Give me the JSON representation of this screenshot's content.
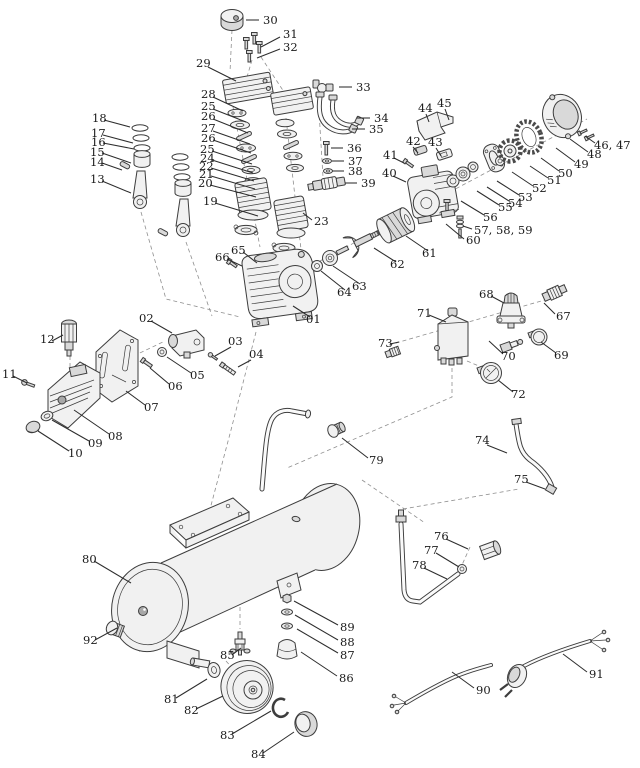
{
  "figure": {
    "background_color": "#ffffff",
    "line_color": "#3d3d3d",
    "label_color": "#1b1b1b",
    "leader_color": "#2d2d2d",
    "dashed_guide_color": "#8f8f8f"
  },
  "labels": [
    {
      "t": "30",
      "x": 263,
      "y": 24,
      "x1": 259,
      "y1": 20,
      "x2": 246,
      "y2": 20
    },
    {
      "t": "31",
      "x": 283,
      "y": 38,
      "x1": 280,
      "y1": 37,
      "x2": 261,
      "y2": 47
    },
    {
      "t": "32",
      "x": 283,
      "y": 51,
      "x1": 280,
      "y1": 49,
      "x2": 257,
      "y2": 58
    },
    {
      "t": "29",
      "x": 196,
      "y": 67,
      "x1": 208,
      "y1": 67,
      "x2": 236,
      "y2": 81
    },
    {
      "t": "28",
      "x": 201,
      "y": 98,
      "x1": 213,
      "y1": 97,
      "x2": 243,
      "y2": 111
    },
    {
      "t": "25",
      "x": 201,
      "y": 110,
      "x1": 213,
      "y1": 109,
      "x2": 246,
      "y2": 122
    },
    {
      "t": "26",
      "x": 201,
      "y": 120,
      "x1": 213,
      "y1": 119,
      "x2": 248,
      "y2": 133
    },
    {
      "t": "27",
      "x": 201,
      "y": 132,
      "x1": 213,
      "y1": 131,
      "x2": 250,
      "y2": 144
    },
    {
      "t": "26",
      "x": 201,
      "y": 142,
      "x1": 213,
      "y1": 140,
      "x2": 251,
      "y2": 153
    },
    {
      "t": "25",
      "x": 200,
      "y": 153,
      "x1": 212,
      "y1": 151,
      "x2": 252,
      "y2": 164
    },
    {
      "t": "24",
      "x": 200,
      "y": 162,
      "x1": 212,
      "y1": 160,
      "x2": 253,
      "y2": 173
    },
    {
      "t": "22",
      "x": 199,
      "y": 170,
      "x1": 211,
      "y1": 168,
      "x2": 254,
      "y2": 181
    },
    {
      "t": "21",
      "x": 199,
      "y": 178,
      "x1": 211,
      "y1": 176,
      "x2": 255,
      "y2": 189
    },
    {
      "t": "20",
      "x": 198,
      "y": 187,
      "x1": 210,
      "y1": 185,
      "x2": 256,
      "y2": 197
    },
    {
      "t": "19",
      "x": 203,
      "y": 205,
      "x1": 215,
      "y1": 203,
      "x2": 258,
      "y2": 216
    },
    {
      "t": "18",
      "x": 92,
      "y": 122,
      "x1": 104,
      "y1": 120,
      "x2": 130,
      "y2": 127
    },
    {
      "t": "17",
      "x": 91,
      "y": 137,
      "x1": 103,
      "y1": 135,
      "x2": 133,
      "y2": 143
    },
    {
      "t": "16",
      "x": 91,
      "y": 146,
      "x1": 103,
      "y1": 143,
      "x2": 134,
      "y2": 149
    },
    {
      "t": "15",
      "x": 90,
      "y": 156,
      "x1": 102,
      "y1": 153,
      "x2": 131,
      "y2": 163
    },
    {
      "t": "14",
      "x": 90,
      "y": 166,
      "x1": 102,
      "y1": 163,
      "x2": 122,
      "y2": 170
    },
    {
      "t": "13",
      "x": 90,
      "y": 183,
      "x1": 102,
      "y1": 181,
      "x2": 131,
      "y2": 193
    },
    {
      "t": "33",
      "x": 356,
      "y": 91,
      "x1": 352,
      "y1": 87,
      "x2": 339,
      "y2": 87
    },
    {
      "t": "34",
      "x": 374,
      "y": 122,
      "x1": 370,
      "y1": 118,
      "x2": 357,
      "y2": 118
    },
    {
      "t": "35",
      "x": 369,
      "y": 133,
      "x1": 365,
      "y1": 129,
      "x2": 352,
      "y2": 129
    },
    {
      "t": "36",
      "x": 347,
      "y": 152,
      "x1": 343,
      "y1": 148,
      "x2": 331,
      "y2": 148
    },
    {
      "t": "37",
      "x": 348,
      "y": 165,
      "x1": 344,
      "y1": 161,
      "x2": 332,
      "y2": 161
    },
    {
      "t": "38",
      "x": 348,
      "y": 175,
      "x1": 344,
      "y1": 171,
      "x2": 332,
      "y2": 171
    },
    {
      "t": "39",
      "x": 361,
      "y": 187,
      "x1": 357,
      "y1": 183,
      "x2": 345,
      "y2": 183
    },
    {
      "t": "23",
      "x": 314,
      "y": 225,
      "x1": 312,
      "y1": 220,
      "x2": 303,
      "y2": 213
    },
    {
      "t": "65",
      "x": 231,
      "y": 254,
      "x1": 243,
      "y1": 252,
      "x2": 257,
      "y2": 263
    },
    {
      "t": "66",
      "x": 215,
      "y": 261,
      "x1": 227,
      "y1": 259,
      "x2": 242,
      "y2": 266
    },
    {
      "t": "64",
      "x": 337,
      "y": 296,
      "x1": 345,
      "y1": 290,
      "x2": 321,
      "y2": 271
    },
    {
      "t": "63",
      "x": 352,
      "y": 290,
      "x1": 360,
      "y1": 284,
      "x2": 333,
      "y2": 266
    },
    {
      "t": "62",
      "x": 390,
      "y": 268,
      "x1": 396,
      "y1": 262,
      "x2": 374,
      "y2": 248
    },
    {
      "t": "61",
      "x": 422,
      "y": 257,
      "x1": 428,
      "y1": 251,
      "x2": 406,
      "y2": 236
    },
    {
      "t": "01",
      "x": 306,
      "y": 323,
      "x1": 310,
      "y1": 317,
      "x2": 293,
      "y2": 306
    },
    {
      "t": "02",
      "x": 139,
      "y": 322,
      "x1": 151,
      "y1": 321,
      "x2": 172,
      "y2": 333
    },
    {
      "t": "03",
      "x": 228,
      "y": 345,
      "x1": 231,
      "y1": 347,
      "x2": 215,
      "y2": 356
    },
    {
      "t": "04",
      "x": 249,
      "y": 358,
      "x1": 251,
      "y1": 360,
      "x2": 238,
      "y2": 367
    },
    {
      "t": "05",
      "x": 190,
      "y": 379,
      "x1": 191,
      "y1": 373,
      "x2": 167,
      "y2": 357
    },
    {
      "t": "06",
      "x": 168,
      "y": 390,
      "x1": 169,
      "y1": 384,
      "x2": 150,
      "y2": 368
    },
    {
      "t": "07",
      "x": 144,
      "y": 411,
      "x1": 145,
      "y1": 405,
      "x2": 126,
      "y2": 391
    },
    {
      "t": "08",
      "x": 108,
      "y": 440,
      "x1": 109,
      "y1": 434,
      "x2": 74,
      "y2": 410
    },
    {
      "t": "09",
      "x": 88,
      "y": 447,
      "x1": 89,
      "y1": 441,
      "x2": 52,
      "y2": 420
    },
    {
      "t": "10",
      "x": 68,
      "y": 457,
      "x1": 69,
      "y1": 451,
      "x2": 38,
      "y2": 431
    },
    {
      "t": "11",
      "x": 2,
      "y": 378,
      "x1": 13,
      "y1": 376,
      "x2": 27,
      "y2": 383
    },
    {
      "t": "12",
      "x": 40,
      "y": 343,
      "x1": 52,
      "y1": 341,
      "x2": 63,
      "y2": 335
    },
    {
      "t": "44",
      "x": 418,
      "y": 112,
      "x1": 426,
      "y1": 114,
      "x2": 429,
      "y2": 122
    },
    {
      "t": "45",
      "x": 437,
      "y": 107,
      "x1": 445,
      "y1": 109,
      "x2": 449,
      "y2": 120
    },
    {
      "t": "42",
      "x": 406,
      "y": 145,
      "x1": 413,
      "y1": 147,
      "x2": 418,
      "y2": 153
    },
    {
      "t": "43",
      "x": 428,
      "y": 146,
      "x1": 436,
      "y1": 148,
      "x2": 441,
      "y2": 156
    },
    {
      "t": "41",
      "x": 383,
      "y": 159,
      "x1": 394,
      "y1": 158,
      "x2": 404,
      "y2": 163
    },
    {
      "t": "40",
      "x": 382,
      "y": 177,
      "x1": 393,
      "y1": 176,
      "x2": 406,
      "y2": 182
    },
    {
      "t": "46, 47",
      "x": 594,
      "y": 149,
      "x1": 595,
      "y1": 143,
      "x2": 585,
      "y2": 136
    },
    {
      "t": "48",
      "x": 587,
      "y": 158,
      "x1": 588,
      "y1": 152,
      "x2": 570,
      "y2": 139
    },
    {
      "t": "49",
      "x": 574,
      "y": 168,
      "x1": 575,
      "y1": 162,
      "x2": 556,
      "y2": 148
    },
    {
      "t": "50",
      "x": 558,
      "y": 177,
      "x1": 559,
      "y1": 171,
      "x2": 541,
      "y2": 158
    },
    {
      "t": "51",
      "x": 547,
      "y": 184,
      "x1": 548,
      "y1": 178,
      "x2": 530,
      "y2": 166
    },
    {
      "t": "52",
      "x": 532,
      "y": 192,
      "x1": 533,
      "y1": 186,
      "x2": 512,
      "y2": 172
    },
    {
      "t": "53",
      "x": 518,
      "y": 201,
      "x1": 519,
      "y1": 195,
      "x2": 497,
      "y2": 181
    },
    {
      "t": "54",
      "x": 508,
      "y": 207,
      "x1": 509,
      "y1": 201,
      "x2": 487,
      "y2": 187
    },
    {
      "t": "55",
      "x": 498,
      "y": 211,
      "x1": 499,
      "y1": 205,
      "x2": 477,
      "y2": 191
    },
    {
      "t": "56",
      "x": 483,
      "y": 221,
      "x1": 484,
      "y1": 215,
      "x2": 461,
      "y2": 201
    },
    {
      "t": "57, 58, 59",
      "x": 474,
      "y": 234,
      "x1": 472,
      "y1": 229,
      "x2": 463,
      "y2": 226
    },
    {
      "t": "60",
      "x": 466,
      "y": 244,
      "x1": 464,
      "y1": 239,
      "x2": 446,
      "y2": 224
    },
    {
      "t": "68",
      "x": 479,
      "y": 298,
      "x1": 491,
      "y1": 296,
      "x2": 504,
      "y2": 303
    },
    {
      "t": "67",
      "x": 556,
      "y": 320,
      "x1": 555,
      "y1": 314,
      "x2": 544,
      "y2": 303
    },
    {
      "t": "71",
      "x": 417,
      "y": 317,
      "x1": 429,
      "y1": 315,
      "x2": 446,
      "y2": 322
    },
    {
      "t": "73",
      "x": 378,
      "y": 347,
      "x1": 390,
      "y1": 344,
      "x2": 399,
      "y2": 342
    },
    {
      "t": "70",
      "x": 501,
      "y": 360,
      "x1": 503,
      "y1": 354,
      "x2": 489,
      "y2": 341
    },
    {
      "t": "69",
      "x": 554,
      "y": 359,
      "x1": 556,
      "y1": 353,
      "x2": 541,
      "y2": 342
    },
    {
      "t": "72",
      "x": 511,
      "y": 398,
      "x1": 513,
      "y1": 392,
      "x2": 498,
      "y2": 380
    },
    {
      "t": "79",
      "x": 369,
      "y": 464,
      "x1": 368,
      "y1": 458,
      "x2": 342,
      "y2": 438
    },
    {
      "t": "74",
      "x": 475,
      "y": 444,
      "x1": 487,
      "y1": 445,
      "x2": 507,
      "y2": 453
    },
    {
      "t": "75",
      "x": 514,
      "y": 483,
      "x1": 526,
      "y1": 482,
      "x2": 545,
      "y2": 489
    },
    {
      "t": "76",
      "x": 434,
      "y": 540,
      "x1": 446,
      "y1": 539,
      "x2": 468,
      "y2": 549
    },
    {
      "t": "77",
      "x": 424,
      "y": 554,
      "x1": 436,
      "y1": 553,
      "x2": 459,
      "y2": 567
    },
    {
      "t": "78",
      "x": 412,
      "y": 569,
      "x1": 424,
      "y1": 568,
      "x2": 447,
      "y2": 579
    },
    {
      "t": "80",
      "x": 82,
      "y": 563,
      "x1": 94,
      "y1": 561,
      "x2": 131,
      "y2": 583
    },
    {
      "t": "92",
      "x": 83,
      "y": 644,
      "x1": 95,
      "y1": 640,
      "x2": 117,
      "y2": 628
    },
    {
      "t": "85",
      "x": 220,
      "y": 659,
      "x1": 232,
      "y1": 655,
      "x2": 241,
      "y2": 648
    },
    {
      "t": "81",
      "x": 164,
      "y": 703,
      "x1": 176,
      "y1": 698,
      "x2": 207,
      "y2": 679
    },
    {
      "t": "82",
      "x": 184,
      "y": 714,
      "x1": 196,
      "y1": 709,
      "x2": 223,
      "y2": 696
    },
    {
      "t": "83",
      "x": 220,
      "y": 739,
      "x1": 232,
      "y1": 734,
      "x2": 271,
      "y2": 711
    },
    {
      "t": "84",
      "x": 251,
      "y": 758,
      "x1": 263,
      "y1": 753,
      "x2": 294,
      "y2": 732
    },
    {
      "t": "89",
      "x": 340,
      "y": 631,
      "x1": 338,
      "y1": 625,
      "x2": 294,
      "y2": 601
    },
    {
      "t": "88",
      "x": 340,
      "y": 646,
      "x1": 338,
      "y1": 640,
      "x2": 295,
      "y2": 615
    },
    {
      "t": "87",
      "x": 340,
      "y": 659,
      "x1": 338,
      "y1": 653,
      "x2": 297,
      "y2": 629
    },
    {
      "t": "86",
      "x": 339,
      "y": 682,
      "x1": 337,
      "y1": 676,
      "x2": 301,
      "y2": 652
    },
    {
      "t": "90",
      "x": 476,
      "y": 694,
      "x1": 474,
      "y1": 688,
      "x2": 452,
      "y2": 672
    },
    {
      "t": "91",
      "x": 589,
      "y": 678,
      "x1": 587,
      "y1": 672,
      "x2": 563,
      "y2": 654
    }
  ]
}
